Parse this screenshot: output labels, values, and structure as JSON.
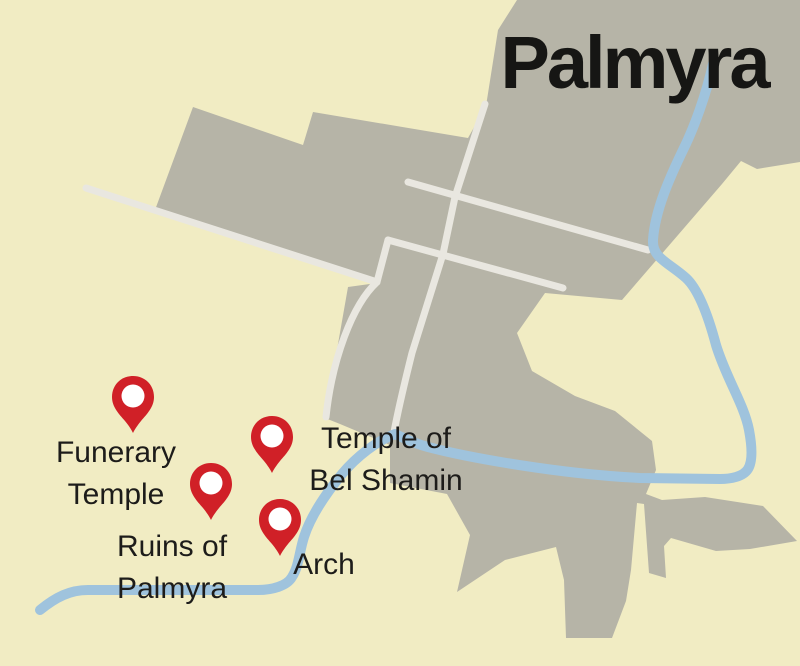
{
  "title": "Palmyra",
  "map": {
    "type": "tourist-map",
    "place": "Palmyra",
    "features": {
      "urban_area": "city built-up area",
      "river": "watercourse through city",
      "roads": [
        "northwest road",
        "main avenue",
        "upper east road",
        "lower east road",
        "west corridor road",
        "connector road"
      ]
    }
  },
  "markers": [
    {
      "id": "funerary-temple",
      "label_lines": [
        "Funerary",
        "Temple"
      ]
    },
    {
      "id": "temple-of-bel-shamin",
      "label_lines": [
        "Temple of",
        "Bel Shamin"
      ]
    },
    {
      "id": "ruins-of-palmyra",
      "label_lines": [
        "Ruins of",
        "Palmyra"
      ]
    },
    {
      "id": "arch",
      "label_lines": [
        "Arch"
      ]
    }
  ],
  "colors": {
    "background": "#f1ecc3",
    "urban": "#b6b4a7",
    "road": "#e9e7e0",
    "river": "#9fc3dd",
    "pin": "#d02027",
    "pin_inner": "#ffffff",
    "label_text": "#1d1c1a",
    "title_text": "#161614"
  }
}
